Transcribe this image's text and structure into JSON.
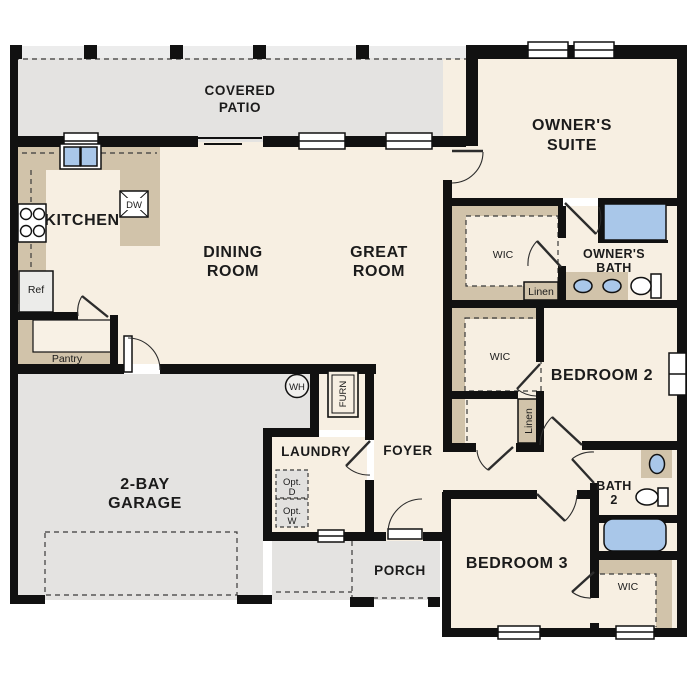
{
  "meta": {
    "type": "residential floor plan",
    "colors": {
      "wall": "#111111",
      "interior_floor": "#f7efe2",
      "outdoor_concrete": "#e4e3e1",
      "casework_tan": "#d1c3aa",
      "plumbing_blue": "#a9c7e9",
      "appliance_gray": "#ececea"
    }
  },
  "rooms": {
    "covered_patio": {
      "line1": "COVERED",
      "line2": "PATIO"
    },
    "owners_suite": {
      "line1": "OWNER'S",
      "line2": "SUITE"
    },
    "kitchen": {
      "label": "KITCHEN"
    },
    "dining_room": {
      "line1": "DINING",
      "line2": "ROOM"
    },
    "great_room": {
      "line1": "GREAT",
      "line2": "ROOM"
    },
    "owners_wic": {
      "label": "WIC"
    },
    "owners_bath": {
      "line1": "OWNER'S",
      "line2": "BATH"
    },
    "bedroom_2": {
      "label": "BEDROOM 2"
    },
    "bedroom_2_wic": {
      "label": "WIC"
    },
    "laundry": {
      "label": "LAUNDRY"
    },
    "foyer": {
      "label": "FOYER"
    },
    "garage": {
      "line1": "2-BAY",
      "line2": "GARAGE"
    },
    "bath_2": {
      "line1": "BATH",
      "line2": "2"
    },
    "porch": {
      "label": "PORCH"
    },
    "bedroom_3": {
      "label": "BEDROOM 3"
    },
    "bedroom_3_wic": {
      "label": "WIC"
    }
  },
  "closets": {
    "pantry": "Pantry",
    "linen_owner": "Linen",
    "linen_hall": "Linen"
  },
  "appliances": {
    "ref": "Ref",
    "dw": "DW",
    "wh": "WH",
    "furn": "FURN",
    "opt_dryer": {
      "line1": "Opt.",
      "line2": "D"
    },
    "opt_washer": {
      "line1": "Opt.",
      "line2": "W"
    }
  }
}
